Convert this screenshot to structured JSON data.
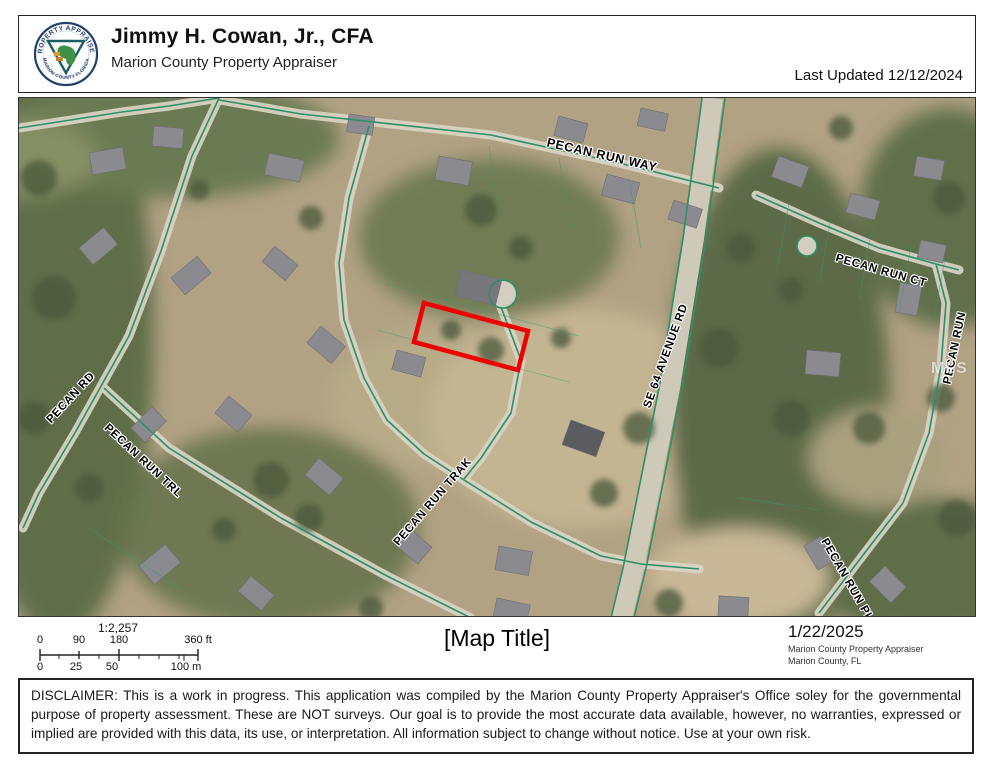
{
  "header": {
    "name": "Jimmy H. Cowan, Jr., CFA",
    "subtitle": "Marion County Property Appraiser",
    "last_updated": "Last Updated 12/12/2024",
    "seal_top": "PROPERTY APPRAISER",
    "seal_bottom": "MARION COUNTY FLORIDA"
  },
  "map": {
    "street_labels": [
      {
        "id": "pecan-run-way",
        "text": "PECAN RUN WAY"
      },
      {
        "id": "pecan-run-ct",
        "text": "PECAN RUN CT"
      },
      {
        "id": "pecan-run",
        "text": "PECAN RUN"
      },
      {
        "id": "se-64-avenue-rd",
        "text": "SE 64 AVENUE RD"
      },
      {
        "id": "pecan-rd",
        "text": "PECAN RD"
      },
      {
        "id": "pecan-run-trl",
        "text": "PECAN RUN TRL"
      },
      {
        "id": "pecan-run-trak",
        "text": "PECAN RUN TRAK"
      },
      {
        "id": "pecan-run-pl",
        "text": "PECAN RUN PL"
      }
    ],
    "watermark": "MLS",
    "highlight_color": "#ee0000",
    "road_line_color": "#2e8f68"
  },
  "footer": {
    "scale_ratio": "1:2,257",
    "ft_ticks": [
      "0",
      "90",
      "180",
      "360 ft"
    ],
    "m_ticks": [
      "0",
      "25",
      "50",
      "100 m"
    ],
    "map_title": "[Map Title]",
    "date": "1/22/2025",
    "attribution_line1": "Marion County Property Appraiser",
    "attribution_line2": "Marion County, FL"
  },
  "disclaimer": "DISCLAIMER: This is a work in progress. This application was compiled by the Marion County Property Appraiser's Office soley for the governmental purpose of property assessment. These are NOT surveys. Our goal is to provide the most accurate data available, however, no warranties, expressed or implied are provided with this data, its use, or interpretation. All information subject to change without notice. Use at your own risk."
}
